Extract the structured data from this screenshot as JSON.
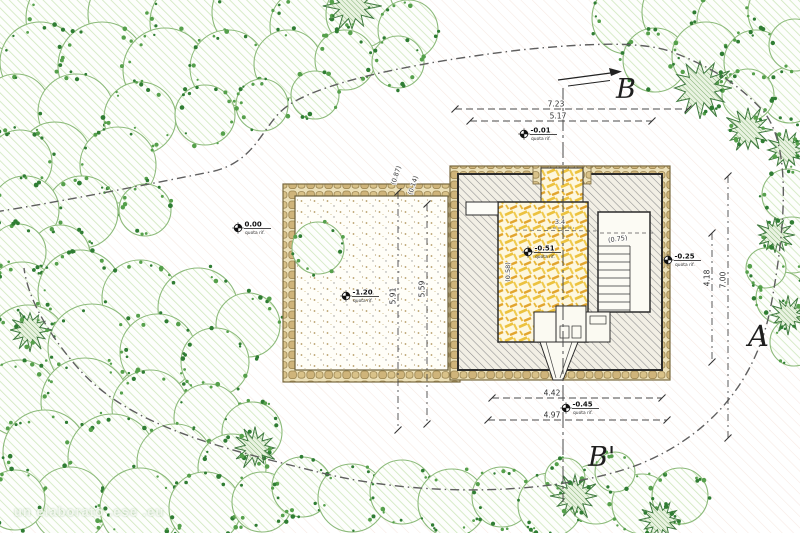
{
  "plan": {
    "title": "site plan with building footprint",
    "section_labels": {
      "top": "B",
      "bottom": "B'",
      "right": "A"
    },
    "dimensions_top": [
      "7.23",
      "5.17"
    ],
    "dimensions_bottom": [
      "4.42",
      "4.97"
    ],
    "dimensions_right": [
      "4.18",
      "7.00"
    ],
    "dimensions_courtyard": [
      "5.91",
      "5.59"
    ],
    "elevation_markers": [
      {
        "value": "-0.01",
        "note": "quota rif."
      },
      {
        "value": "0.00",
        "note": "quota rif."
      },
      {
        "value": "-1.20",
        "note": "quota rif."
      },
      {
        "value": "-0.51",
        "note": "quota rif."
      },
      {
        "value": "-0.25",
        "note": "quota rif."
      },
      {
        "value": "-0.45",
        "note": "quota rif."
      }
    ],
    "annotations": [
      "(0.87)",
      "(0.14)",
      "3.4",
      "(0.58)",
      "(0.75)"
    ],
    "watermark": "un elaborato .ese .eu",
    "colors": {
      "vegetation_dots": "#2f7d33",
      "vegetation_hatch": "#cfe7bd",
      "stone_wall": "#cdb277",
      "building_hatch": "#8e8e8e",
      "floor_yellow": "#ecc23e",
      "line": "#4a4a4a"
    }
  }
}
